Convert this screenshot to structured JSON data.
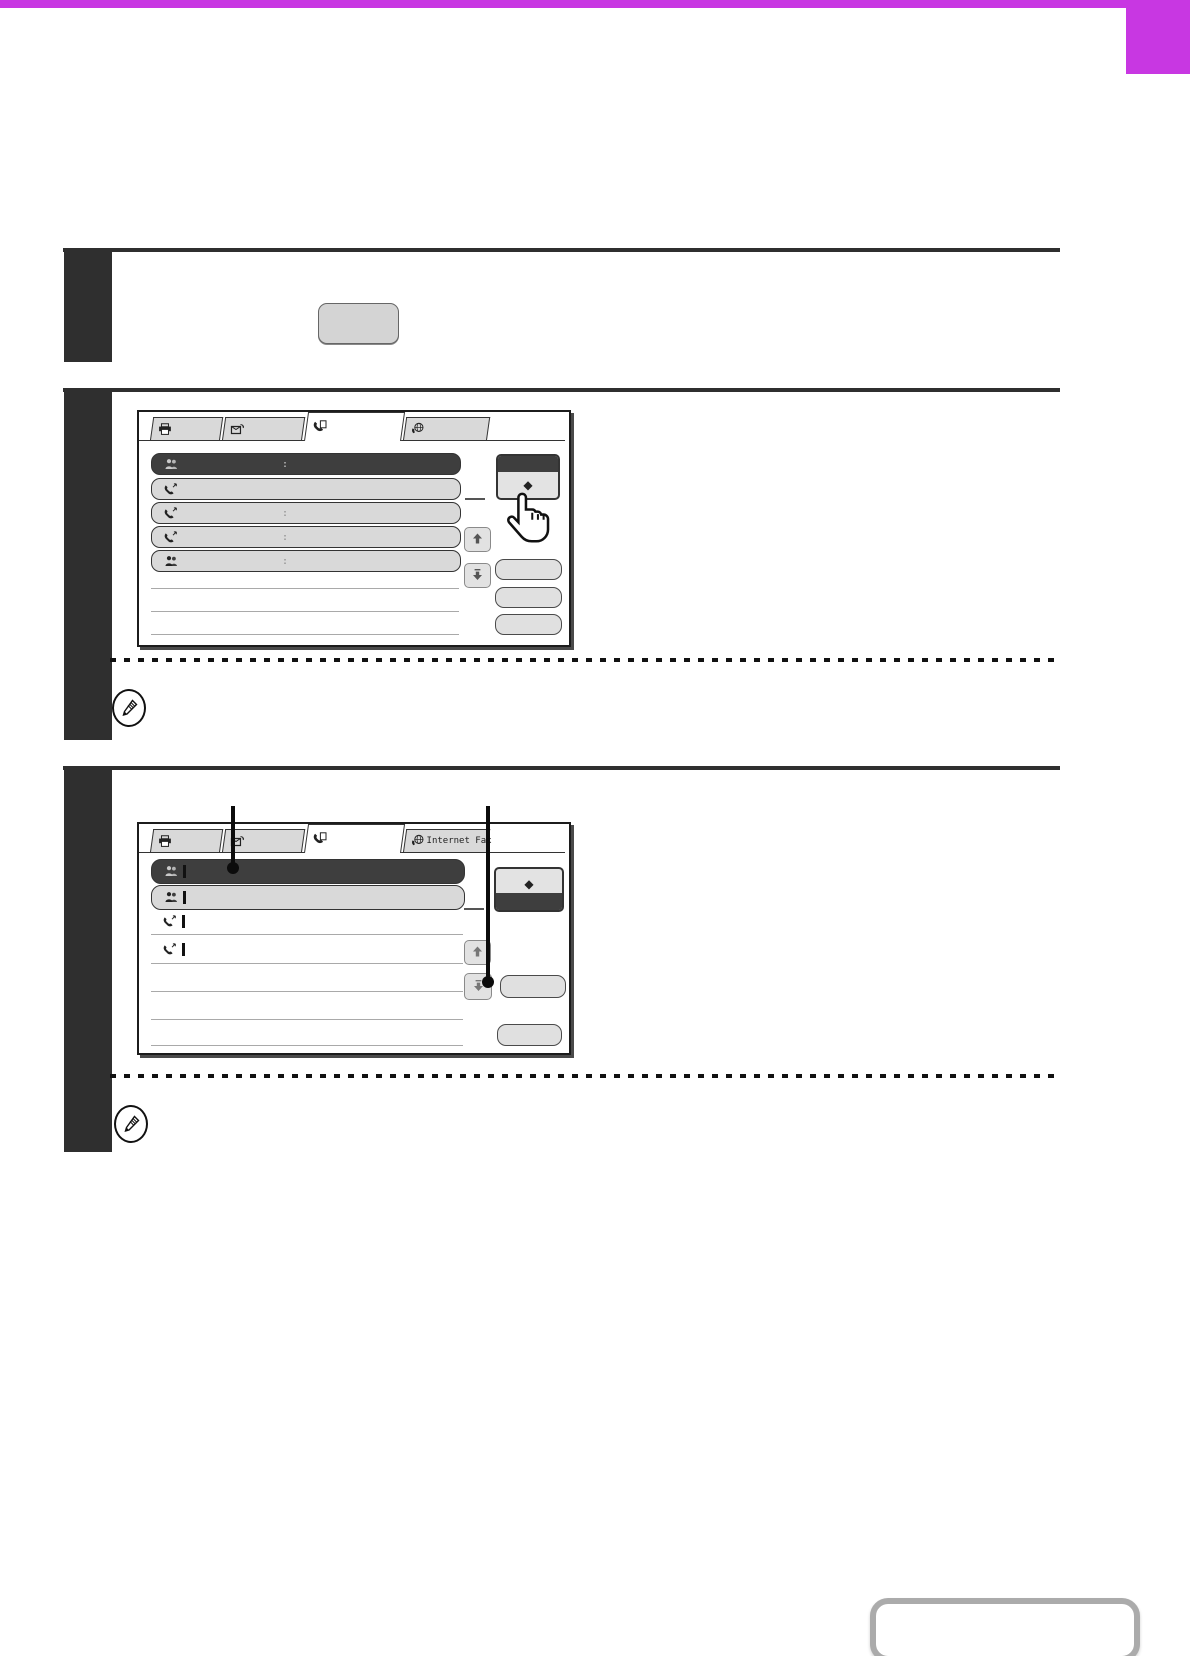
{
  "accent_color": "#c837e2",
  "step1": {
    "key_button_label": ""
  },
  "panel1": {
    "tabs": [
      {
        "icon": "printer-icon",
        "label": "",
        "selected": false
      },
      {
        "icon": "document-send-icon",
        "label": "",
        "selected": false
      },
      {
        "icon": "fax-icon",
        "label": "",
        "selected": true
      },
      {
        "icon": "internet-fax-icon",
        "label": "",
        "selected": false
      }
    ],
    "address_keys": [
      {
        "icon": "group-contact-icon",
        "state": "selected",
        "divider": ":"
      },
      {
        "icon": "fax-contact-icon",
        "state": "normal",
        "divider": ""
      },
      {
        "icon": "fax-contact-icon",
        "state": "normal",
        "divider": ":"
      },
      {
        "icon": "fax-contact-icon",
        "state": "normal",
        "divider": ":"
      },
      {
        "icon": "group-contact-icon",
        "state": "normal",
        "divider": ":"
      }
    ],
    "sort_toggle": {
      "glyph": "◆",
      "dark_band": "top"
    },
    "scroll_up_icon": "up-arrow-icon",
    "scroll_down_icon": "down-arrow-icon",
    "side_buttons": [
      "",
      "",
      ""
    ],
    "cursor": "pointing-hand-cursor"
  },
  "panel2": {
    "tabs": [
      {
        "icon": "printer-icon",
        "label": "",
        "selected": false
      },
      {
        "icon": "document-send-icon",
        "label": "",
        "selected": false
      },
      {
        "icon": "fax-icon",
        "label": "",
        "selected": true
      },
      {
        "icon": "internet-fax-icon",
        "label": "Internet Fax",
        "selected": false
      }
    ],
    "address_keys": [
      {
        "icon": "group-contact-icon",
        "state": "selected",
        "marker": true
      },
      {
        "icon": "group-contact-icon",
        "state": "normal",
        "marker": true
      },
      {
        "icon": "fax-contact-icon",
        "state": "plain",
        "marker": true
      },
      {
        "icon": "fax-contact-icon",
        "state": "plain",
        "marker": true
      }
    ],
    "sort_toggle": {
      "glyph": "◆",
      "dark_band": "bottom"
    },
    "scroll_up_icon": "up-arrow-icon",
    "scroll_down_icon": "down-arrow-icon",
    "side_buttons": [
      "",
      ""
    ],
    "callouts": [
      {
        "points_to": "selected-address-key"
      },
      {
        "points_to": "side-button-next-to-scroll-down"
      }
    ]
  },
  "notes": [
    {
      "icon": "pencil-note-icon"
    },
    {
      "icon": "pencil-note-icon"
    }
  ],
  "footer": {
    "nav_button_label": ""
  }
}
